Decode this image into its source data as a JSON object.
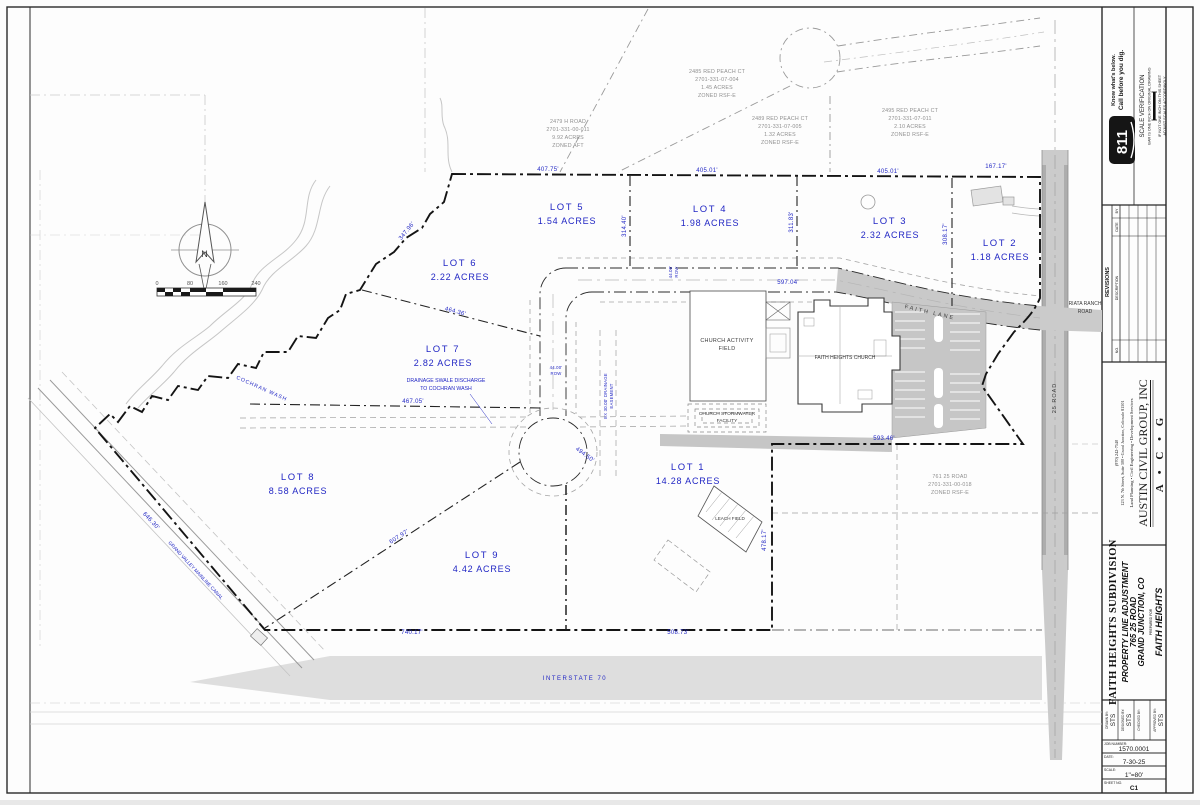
{
  "sheet": {
    "utility": {
      "logo": "811",
      "know": "Know what's below.",
      "call": "Call before you dig.",
      "sv_title": "SCALE VERIFICATION",
      "sv_line1": "BAR IS ONE INCH ON ORIGINAL DRAWING",
      "sv_line2": "IF NOT ONE INCH ON THIS SHEET",
      "sv_line3": "ADJUST SCALES ACCORDINGLY"
    },
    "revisions": {
      "title": "REVISIONS",
      "col_no": "NO.",
      "col_description": "DESCRIPTION",
      "col_date": "DATE",
      "col_by": "BY"
    },
    "firm": {
      "initials": "A • C • G",
      "name": "AUSTIN CIVIL GROUP, INC",
      "services": "Land Planning • Civil Engineering • Development Services",
      "address": "123 N. 7th Street, Suite 300 • Grand Junction, Colorado 81501",
      "phone": "(970) 242-7540"
    },
    "project": {
      "subdivision": "FAITH HEIGHTS SUBDIVISION",
      "line1": "PROPERTY LINE ADJUSTMENT",
      "line2": "765 25 ROAD",
      "line3": "GRAND JUNCTION, CO",
      "prepared_for": "PREPARED FOR",
      "client": "FAITH HEIGHTS"
    },
    "block": {
      "drawn_label": "DRAWN BY:",
      "drawn": "STS",
      "designed_label": "DESIGNED BY:",
      "designed": "STS",
      "checked_label": "CHECKED BY:",
      "checked": "",
      "approved_label": "APPROVED BY:",
      "approved": "STS",
      "job_label": "JOB NUMBER:",
      "job": "1570.0001",
      "date_label": "DATE:",
      "date": "7-30-25",
      "scale_label": "SCALE:",
      "scale": "1\"=80'",
      "sheetno_label": "SHEET NO.",
      "sheetno": "C1"
    }
  },
  "plan": {
    "north": "N",
    "scale_ticks": [
      "0",
      "80",
      "160",
      "240"
    ],
    "lots": [
      {
        "name": "LOT 1",
        "acres": "14.28 ACRES"
      },
      {
        "name": "LOT 2",
        "acres": "1.18 ACRES"
      },
      {
        "name": "LOT 3",
        "acres": "2.32 ACRES"
      },
      {
        "name": "LOT 4",
        "acres": "1.98 ACRES"
      },
      {
        "name": "LOT 5",
        "acres": "1.54 ACRES"
      },
      {
        "name": "LOT 6",
        "acres": "2.22 ACRES"
      },
      {
        "name": "LOT 7",
        "acres": "2.82 ACRES"
      },
      {
        "name": "LOT 8",
        "acres": "8.58 ACRES"
      },
      {
        "name": "LOT 9",
        "acres": "4.42 ACRES"
      }
    ],
    "parcels": [
      {
        "l1": "2479 H ROAD",
        "l2": "2701-331-00-011",
        "l3": "9.92 ACRES",
        "l4": "ZONED AFT"
      },
      {
        "l1": "2485 RED PEACH CT",
        "l2": "2701-331-07-004",
        "l3": "1.45 ACRES",
        "l4": "ZONED RSF-E"
      },
      {
        "l1": "2489 RED PEACH CT",
        "l2": "2701-331-07-005",
        "l3": "1.32 ACRES",
        "l4": "ZONED RSF-E"
      },
      {
        "l1": "2495 RED PEACH CT",
        "l2": "2701-331-07-011",
        "l3": "2.10 ACRES",
        "l4": "ZONED RSF-E"
      },
      {
        "l1": "761 25 ROAD",
        "l2": "2701-331-00-018",
        "l3": "ZONED RSF-E",
        "l4": ""
      }
    ],
    "labels": {
      "field1": "CHURCH ACTIVITY",
      "field2": "FIELD",
      "church": "FAITH HEIGHTS CHURCH",
      "storm1": "CHURCH STORMWATER",
      "storm2": "FACILITY",
      "leach": "LEACH FIELD",
      "faith_lane": "FAITH LANE",
      "road25": "25 ROAD",
      "riata1": "RIATA RANCH",
      "riata2": "ROAD",
      "i70": "INTERSTATE 70",
      "wash": "COCHRAN WASH",
      "canal": "GRAND VALLEY MAINLINE CANAL",
      "swale1": "DRAINAGE SWALE DISCHARGE",
      "swale2": "TO COCHRAN WASH"
    },
    "dims": {
      "top1": "407.75'",
      "top2": "405.01'",
      "top3": "405.01'",
      "top4": "167.17'",
      "lot5w": "347.96'",
      "lot5e": "314.40'",
      "lot4e": "311.83'",
      "lot3e": "308.17'",
      "roadn": "597.04'",
      "rowne1": "44.00'",
      "rowne2": "ROW",
      "lot67": "464.36'",
      "lot7s": "467.05'",
      "roww1": "44.00'",
      "roww2": "ROW",
      "ease1": "EX 30.00' DRAINAGE",
      "ease2": "EASEMENT",
      "lot1w": "494.50'",
      "excln": "593.46'",
      "exclw": "478.17'",
      "lot89": "607.97'",
      "south1": "740.17'",
      "south2": "508.73'",
      "canal_dim": "646.30'"
    }
  }
}
